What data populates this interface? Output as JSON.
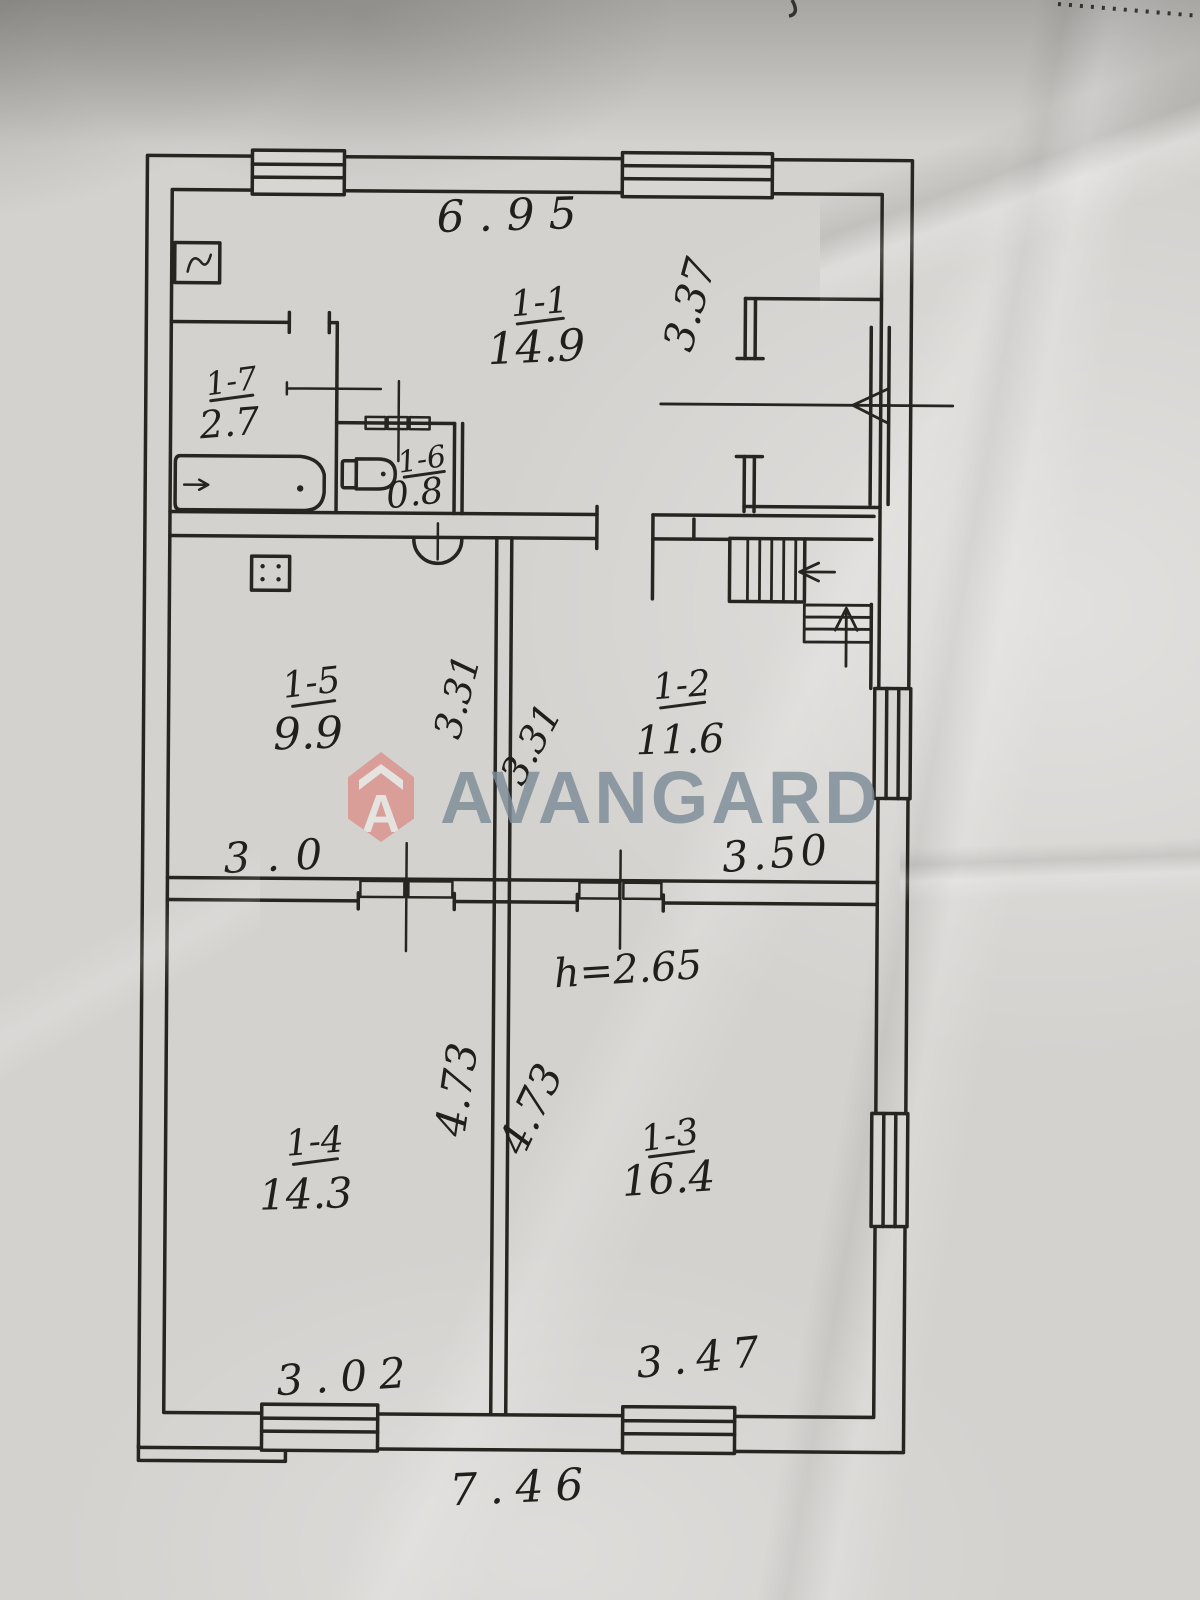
{
  "watermark": {
    "brand": "AVANGARD",
    "shield_letter": "A",
    "shield_color": "#db938b",
    "text_color": "#7e8d98"
  },
  "plan": {
    "rooms": [
      {
        "id": "1-1",
        "area": "14.9"
      },
      {
        "id": "1-2",
        "area": "11.6"
      },
      {
        "id": "1-3",
        "area": "16.4"
      },
      {
        "id": "1-4",
        "area": "14.3"
      },
      {
        "id": "1-5",
        "area": "9.9"
      },
      {
        "id": "1-6",
        "area": "0.8"
      },
      {
        "id": "1-7",
        "area": "2.7"
      }
    ],
    "dimensions": {
      "top_width": "6.95",
      "right_top_height": "3.37",
      "mid_left_depth": "3.31",
      "mid_right_depth": "3.31",
      "mid_left_width": "3.0",
      "mid_right_width": "3.50",
      "ceiling_height": "h=2.65",
      "lower_left_depth": "4.73",
      "lower_right_depth": "4.73",
      "bottom_left_width": "3.02",
      "bottom_right_width": "3.47",
      "bottom_total_width": "7.46"
    },
    "fixtures": [
      "bathtub",
      "toilet",
      "stove",
      "boiler",
      "staircase",
      "entrance-arrow",
      "door-arc",
      "window"
    ]
  }
}
